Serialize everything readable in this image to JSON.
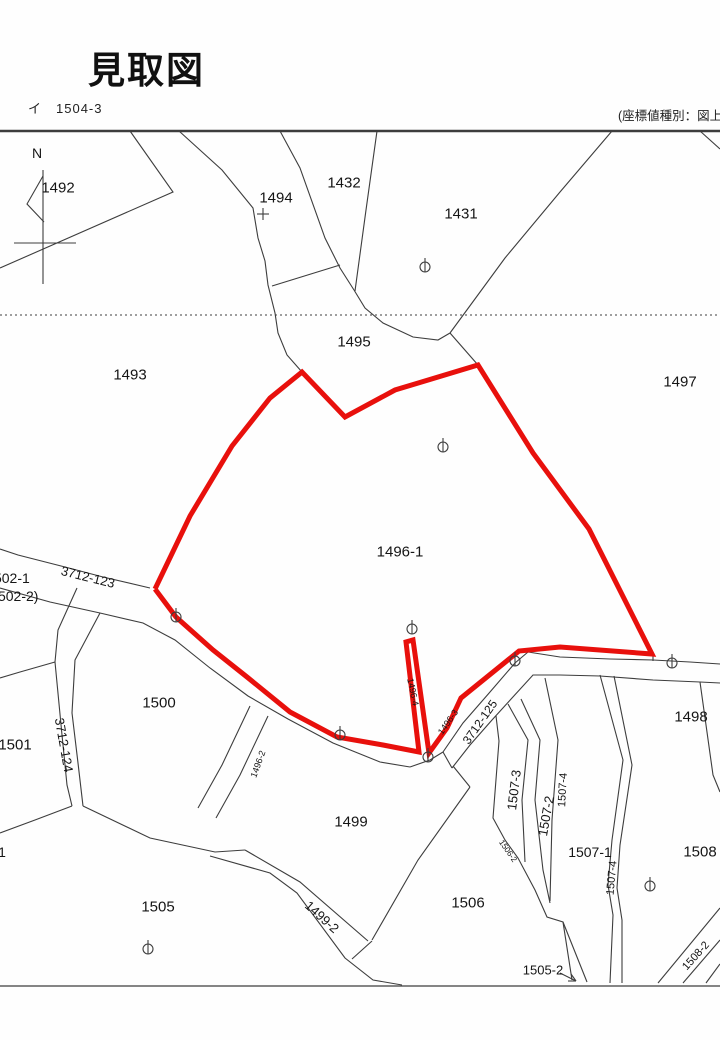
{
  "header": {
    "title": "見取図",
    "sheet_ref_prefix": "イ",
    "sheet_ref": "1504-3",
    "coord_note": "(座標値種別：図上測定)"
  },
  "map": {
    "width": 720,
    "height": 1040,
    "line_color": "#3d3d3d",
    "red_color": "#e8100c",
    "frame": {
      "top": [
        [
          0,
          131
        ],
        [
          720,
          131
        ]
      ],
      "bottom": [
        [
          0,
          986
        ],
        [
          720,
          986
        ]
      ],
      "dotted": [
        [
          0,
          315
        ],
        [
          720,
          315
        ]
      ]
    },
    "red_parcel": {
      "label": "1496-1",
      "points": [
        [
          155,
          589
        ],
        [
          190,
          516
        ],
        [
          232,
          446
        ],
        [
          270,
          398
        ],
        [
          302,
          372
        ],
        [
          345,
          417
        ],
        [
          395,
          390
        ],
        [
          478,
          365
        ],
        [
          533,
          453
        ],
        [
          589,
          529
        ],
        [
          652,
          654
        ],
        [
          560,
          647
        ],
        [
          519,
          651
        ],
        [
          461,
          698
        ],
        [
          447,
          728
        ],
        [
          429,
          753
        ],
        [
          413,
          640
        ],
        [
          406,
          642
        ],
        [
          419,
          752
        ],
        [
          383,
          745
        ],
        [
          337,
          737
        ],
        [
          290,
          712
        ],
        [
          247,
          677
        ],
        [
          213,
          650
        ],
        [
          176,
          617
        ],
        [
          155,
          589
        ]
      ],
      "stroke_width": 5
    },
    "labels": [
      {
        "text": "N",
        "x": 37,
        "y": 153,
        "rot": 0,
        "size": 14,
        "kind": "north-label"
      },
      {
        "text": "1492",
        "x": 58,
        "y": 188,
        "rot": 0,
        "size": 15,
        "kind": "parcel"
      },
      {
        "text": "1494",
        "x": 276,
        "y": 198,
        "rot": 0,
        "size": 15,
        "kind": "parcel"
      },
      {
        "text": "1432",
        "x": 344,
        "y": 183,
        "rot": 0,
        "size": 15,
        "kind": "parcel"
      },
      {
        "text": "1431",
        "x": 461,
        "y": 214,
        "rot": 0,
        "size": 15,
        "kind": "parcel"
      },
      {
        "text": "1495",
        "x": 354,
        "y": 342,
        "rot": 0,
        "size": 15,
        "kind": "parcel"
      },
      {
        "text": "1493",
        "x": 130,
        "y": 375,
        "rot": 0,
        "size": 15,
        "kind": "parcel"
      },
      {
        "text": "1497",
        "x": 680,
        "y": 382,
        "rot": 0,
        "size": 15,
        "kind": "parcel"
      },
      {
        "text": "1496-1",
        "x": 400,
        "y": 552,
        "rot": 0,
        "size": 15,
        "kind": "parcel"
      },
      {
        "text": "1502-1",
        "x": 8,
        "y": 578,
        "rot": 0,
        "size": 14,
        "kind": "parcel"
      },
      {
        "text": "(1502-2)",
        "x": 12,
        "y": 596,
        "rot": 0,
        "size": 14,
        "kind": "parcel"
      },
      {
        "text": "3712-123",
        "x": 88,
        "y": 577,
        "rot": 14,
        "size": 13,
        "kind": "road"
      },
      {
        "text": "1500",
        "x": 159,
        "y": 703,
        "rot": 0,
        "size": 15,
        "kind": "parcel"
      },
      {
        "text": "1501",
        "x": 15,
        "y": 745,
        "rot": 0,
        "size": 15,
        "kind": "parcel"
      },
      {
        "text": "3712-124",
        "x": 64,
        "y": 745,
        "rot": 80,
        "size": 13,
        "kind": "road"
      },
      {
        "text": "1496-4",
        "x": 413,
        "y": 692,
        "rot": 78,
        "size": 9,
        "kind": "parcel"
      },
      {
        "text": "1496-3",
        "x": 448,
        "y": 722,
        "rot": -55,
        "size": 9,
        "kind": "parcel"
      },
      {
        "text": "3712-125",
        "x": 480,
        "y": 722,
        "rot": -55,
        "size": 12,
        "kind": "road"
      },
      {
        "text": "1496-2",
        "x": 258,
        "y": 764,
        "rot": -70,
        "size": 9,
        "kind": "parcel"
      },
      {
        "text": "1499",
        "x": 351,
        "y": 822,
        "rot": 0,
        "size": 15,
        "kind": "parcel"
      },
      {
        "text": "1499-2",
        "x": 322,
        "y": 917,
        "rot": 42,
        "size": 13,
        "kind": "road"
      },
      {
        "text": "1505",
        "x": 158,
        "y": 907,
        "rot": 0,
        "size": 15,
        "kind": "parcel"
      },
      {
        "text": "1506",
        "x": 468,
        "y": 903,
        "rot": 0,
        "size": 15,
        "kind": "parcel"
      },
      {
        "text": "1505-2",
        "x": 543,
        "y": 970,
        "rot": 0,
        "size": 13,
        "kind": "parcel"
      },
      {
        "text": "1506-2",
        "x": 508,
        "y": 851,
        "rot": 55,
        "size": 8,
        "kind": "parcel"
      },
      {
        "text": "1507-3",
        "x": 514,
        "y": 790,
        "rot": -83,
        "size": 13,
        "kind": "parcel"
      },
      {
        "text": "1507-2",
        "x": 546,
        "y": 816,
        "rot": -80,
        "size": 13,
        "kind": "parcel"
      },
      {
        "text": "1507-4",
        "x": 563,
        "y": 790,
        "rot": -87,
        "size": 11,
        "kind": "parcel"
      },
      {
        "text": "1507-1",
        "x": 590,
        "y": 852,
        "rot": 0,
        "size": 14,
        "kind": "parcel"
      },
      {
        "text": "1507-4",
        "x": 612,
        "y": 878,
        "rot": -85,
        "size": 11,
        "kind": "parcel"
      },
      {
        "text": "1508",
        "x": 700,
        "y": 852,
        "rot": 0,
        "size": 15,
        "kind": "parcel"
      },
      {
        "text": "1508-2",
        "x": 696,
        "y": 956,
        "rot": -48,
        "size": 11,
        "kind": "parcel"
      },
      {
        "text": "1498",
        "x": 691,
        "y": 717,
        "rot": 0,
        "size": 15,
        "kind": "parcel"
      },
      {
        "text": "1",
        "x": 2,
        "y": 852,
        "rot": 0,
        "size": 14,
        "kind": "parcel"
      }
    ],
    "markers": [
      [
        425,
        267
      ],
      [
        443,
        447
      ],
      [
        412,
        629
      ],
      [
        340,
        735
      ],
      [
        428,
        757
      ],
      [
        515,
        661
      ],
      [
        672,
        663
      ],
      [
        176,
        617
      ],
      [
        148,
        949
      ],
      [
        650,
        886
      ]
    ],
    "plus_markers": [
      [
        263,
        214
      ]
    ],
    "black_lines": [
      {
        "pts": [
          [
            130,
            131
          ],
          [
            173,
            192
          ],
          [
            0,
            268
          ]
        ]
      },
      {
        "pts": [
          [
            43,
            170
          ],
          [
            43,
            284
          ]
        ]
      },
      {
        "pts": [
          [
            14,
            243
          ],
          [
            76,
            243
          ]
        ]
      },
      {
        "pts": [
          [
            43,
            176
          ],
          [
            27,
            204
          ],
          [
            44,
            222
          ]
        ]
      },
      {
        "pts": [
          [
            179,
            131
          ],
          [
            222,
            170
          ],
          [
            253,
            208
          ],
          [
            258,
            238
          ],
          [
            265,
            261
          ],
          [
            268,
            285
          ],
          [
            275,
            313
          ],
          [
            278,
            333
          ],
          [
            287,
            355
          ],
          [
            302,
            372
          ]
        ]
      },
      {
        "pts": [
          [
            280,
            131
          ],
          [
            300,
            168
          ],
          [
            325,
            238
          ],
          [
            340,
            268
          ],
          [
            354,
            290
          ]
        ]
      },
      {
        "pts": [
          [
            377,
            131
          ],
          [
            366,
            210
          ],
          [
            355,
            291
          ]
        ]
      },
      {
        "pts": [
          [
            354,
            290
          ],
          [
            365,
            308
          ],
          [
            383,
            323
          ],
          [
            413,
            337
          ],
          [
            438,
            340
          ],
          [
            450,
            333
          ]
        ]
      },
      {
        "pts": [
          [
            450,
            333
          ],
          [
            478,
            365
          ]
        ]
      },
      {
        "pts": [
          [
            450,
            333
          ],
          [
            505,
            258
          ],
          [
            560,
            192
          ],
          [
            612,
            131
          ]
        ]
      },
      {
        "pts": [
          [
            272,
            286
          ],
          [
            340,
            265
          ]
        ]
      },
      {
        "pts": [
          [
            700,
            131
          ],
          [
            720,
            149
          ]
        ]
      },
      {
        "pts": [
          [
            0,
            549
          ],
          [
            18,
            555
          ],
          [
            65,
            567
          ],
          [
            103,
            577
          ],
          [
            150,
            588
          ]
        ]
      },
      {
        "pts": [
          [
            0,
            588
          ],
          [
            50,
            602
          ],
          [
            100,
            613
          ],
          [
            143,
            623
          ],
          [
            175,
            640
          ],
          [
            210,
            668
          ],
          [
            248,
            696
          ],
          [
            288,
            719
          ],
          [
            333,
            743
          ],
          [
            380,
            762
          ],
          [
            410,
            767
          ]
        ]
      },
      {
        "pts": [
          [
            410,
            767
          ],
          [
            430,
            760
          ],
          [
            443,
            752
          ]
        ]
      },
      {
        "pts": [
          [
            443,
            752
          ],
          [
            452,
            768
          ]
        ]
      },
      {
        "pts": [
          [
            77,
            588
          ],
          [
            58,
            630
          ],
          [
            55,
            662
          ],
          [
            62,
            735
          ],
          [
            67,
            785
          ],
          [
            72,
            806
          ]
        ]
      },
      {
        "pts": [
          [
            100,
            613
          ],
          [
            75,
            660
          ],
          [
            72,
            713
          ],
          [
            78,
            763
          ],
          [
            83,
            806
          ]
        ]
      },
      {
        "pts": [
          [
            55,
            662
          ],
          [
            20,
            672
          ],
          [
            0,
            678
          ]
        ]
      },
      {
        "pts": [
          [
            72,
            806
          ],
          [
            35,
            820
          ],
          [
            0,
            833
          ]
        ]
      },
      {
        "pts": [
          [
            83,
            806
          ],
          [
            150,
            838
          ],
          [
            215,
            852
          ],
          [
            245,
            850
          ]
        ]
      },
      {
        "pts": [
          [
            245,
            850
          ],
          [
            300,
            882
          ],
          [
            368,
            941
          ]
        ]
      },
      {
        "pts": [
          [
            210,
            856
          ],
          [
            270,
            873
          ],
          [
            297,
            893
          ],
          [
            345,
            958
          ],
          [
            373,
            980
          ],
          [
            402,
            985
          ]
        ]
      },
      {
        "pts": [
          [
            470,
            787
          ],
          [
            418,
            860
          ],
          [
            372,
            940
          ]
        ]
      },
      {
        "pts": [
          [
            372,
            941
          ],
          [
            352,
            959
          ]
        ]
      },
      {
        "pts": [
          [
            250,
            706
          ],
          [
            222,
            765
          ],
          [
            198,
            808
          ]
        ]
      },
      {
        "pts": [
          [
            268,
            716
          ],
          [
            240,
            775
          ],
          [
            216,
            818
          ]
        ]
      },
      {
        "pts": [
          [
            528,
            652
          ],
          [
            515,
            663
          ],
          [
            490,
            692
          ],
          [
            463,
            723
          ],
          [
            443,
            752
          ]
        ]
      },
      {
        "pts": [
          [
            528,
            652
          ],
          [
            560,
            657
          ],
          [
            610,
            659
          ],
          [
            653,
            660
          ],
          [
            690,
            662
          ],
          [
            720,
            664
          ]
        ]
      },
      {
        "pts": [
          [
            452,
            768
          ],
          [
            470,
            745
          ],
          [
            492,
            720
          ],
          [
            512,
            698
          ],
          [
            533,
            675
          ],
          [
            560,
            675
          ],
          [
            600,
            676
          ],
          [
            653,
            680
          ],
          [
            700,
            682
          ],
          [
            720,
            683
          ]
        ]
      },
      {
        "pts": [
          [
            653,
            656
          ],
          [
            653,
            661
          ]
        ]
      },
      {
        "pts": [
          [
            453,
            766
          ],
          [
            470,
            787
          ]
        ]
      },
      {
        "pts": [
          [
            496,
            716
          ],
          [
            499,
            741
          ],
          [
            493,
            818
          ],
          [
            505,
            840
          ],
          [
            518,
            858
          ],
          [
            535,
            890
          ],
          [
            547,
            917
          ],
          [
            563,
            922
          ],
          [
            587,
            982
          ]
        ]
      },
      {
        "pts": [
          [
            563,
            922
          ],
          [
            572,
            980
          ]
        ]
      },
      {
        "pts": [
          [
            508,
            704
          ],
          [
            528,
            740
          ],
          [
            522,
            800
          ],
          [
            525,
            862
          ]
        ]
      },
      {
        "pts": [
          [
            521,
            699
          ],
          [
            540,
            740
          ],
          [
            535,
            800
          ],
          [
            543,
            870
          ],
          [
            550,
            903
          ]
        ]
      },
      {
        "pts": [
          [
            545,
            678
          ],
          [
            558,
            740
          ],
          [
            552,
            820
          ],
          [
            550,
            901
          ]
        ]
      },
      {
        "pts": [
          [
            600,
            675
          ],
          [
            623,
            760
          ],
          [
            612,
            840
          ],
          [
            608,
            885
          ],
          [
            613,
            915
          ],
          [
            610,
            983
          ]
        ]
      },
      {
        "pts": [
          [
            614,
            676
          ],
          [
            632,
            765
          ],
          [
            620,
            845
          ],
          [
            617,
            888
          ],
          [
            622,
            920
          ],
          [
            622,
            983
          ]
        ]
      },
      {
        "pts": [
          [
            700,
            682
          ],
          [
            713,
            775
          ],
          [
            720,
            792
          ]
        ]
      },
      {
        "pts": [
          [
            658,
            983
          ],
          [
            720,
            908
          ]
        ]
      },
      {
        "pts": [
          [
            683,
            983
          ],
          [
            720,
            940
          ]
        ]
      },
      {
        "pts": [
          [
            706,
            983
          ],
          [
            720,
            964
          ]
        ]
      },
      {
        "pts": [
          [
            560,
            973
          ],
          [
            576,
            981
          ]
        ]
      },
      {
        "pts": [
          [
            576,
            981
          ],
          [
            571,
            974
          ]
        ]
      },
      {
        "pts": [
          [
            576,
            981
          ],
          [
            568,
            981
          ]
        ]
      }
    ]
  }
}
